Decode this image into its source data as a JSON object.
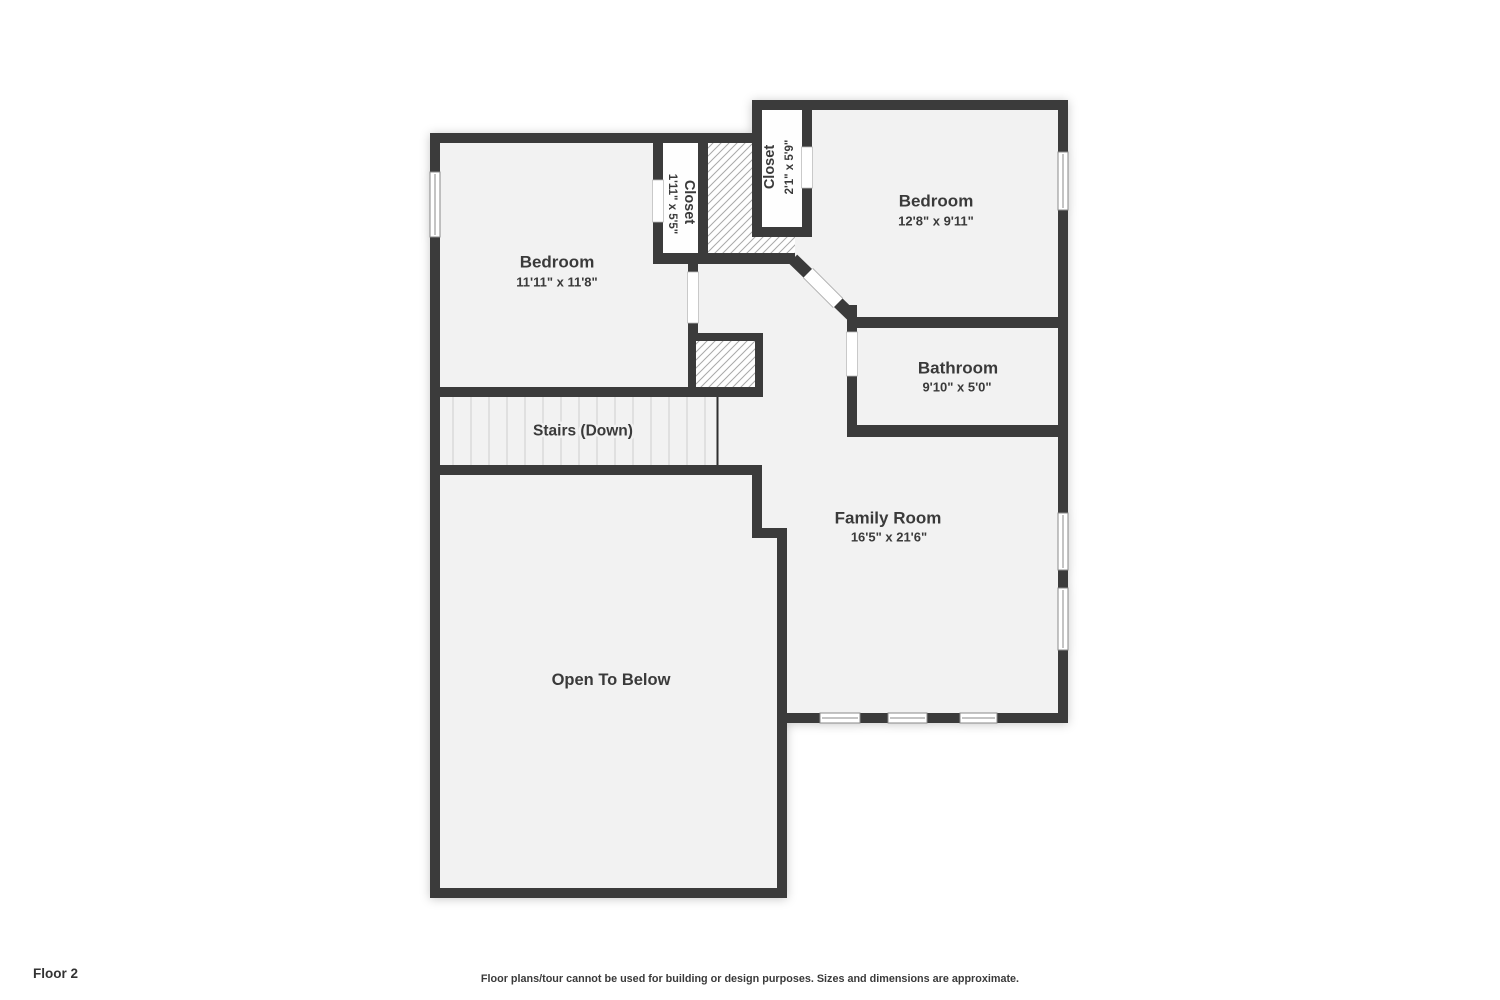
{
  "meta": {
    "floor_label": "Floor 2",
    "disclaimer": "Floor plans/tour cannot be used for building or design purposes. Sizes and dimensions are approximate."
  },
  "colors": {
    "wall": "#3b3b3b",
    "floor_fill": "#f2f2f2",
    "closet_fill": "#fefefe",
    "hatch_line": "#a8a8a8",
    "tread_line": "#cfcfcf",
    "window_line": "#8a8a8a",
    "text": "#3a3a3a"
  },
  "rooms": {
    "bedroom1": {
      "name": "Bedroom",
      "dims": "11'11\" x 11'8\""
    },
    "closet1": {
      "name": "Closet",
      "dims": "1'11\" x 5'5\""
    },
    "closet2": {
      "name": "Closet",
      "dims": "2'1\" x 5'9\""
    },
    "bedroom2": {
      "name": "Bedroom",
      "dims": "12'8\" x 9'11\""
    },
    "bathroom": {
      "name": "Bathroom",
      "dims": "9'10\" x 5'0\""
    },
    "stairs": {
      "name": "Stairs (Down)"
    },
    "family": {
      "name": "Family Room",
      "dims": "16'5\" x 21'6\""
    },
    "open": {
      "name": "Open To Below"
    }
  }
}
